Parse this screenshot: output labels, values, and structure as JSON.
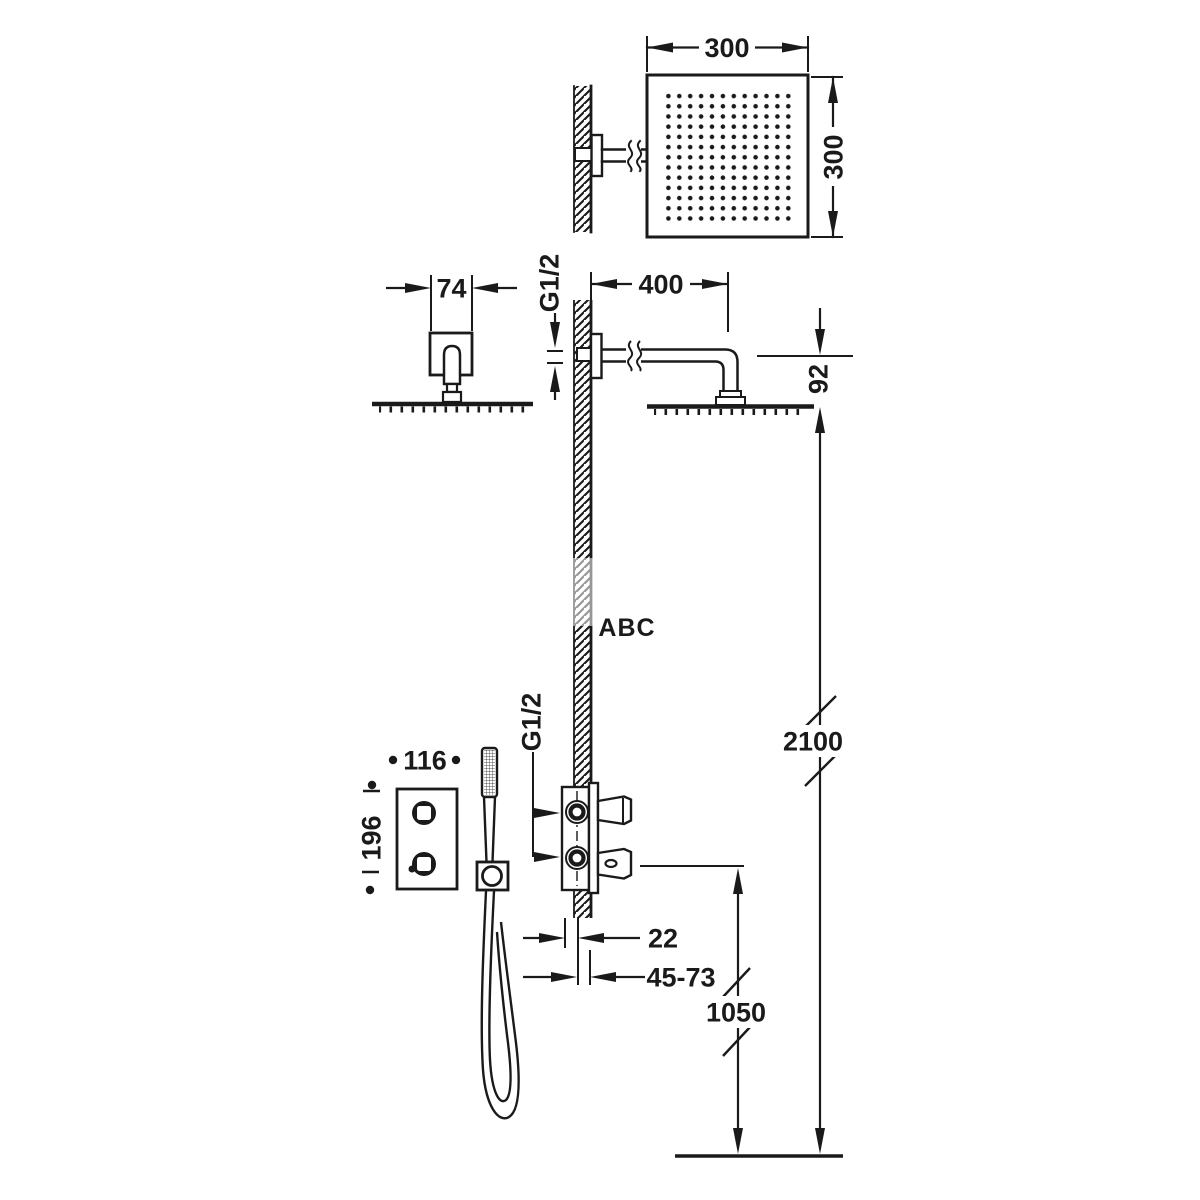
{
  "watermark": {
    "text": "ABC",
    "color": "#8CC63E"
  },
  "dimensions": {
    "head_width": "300",
    "head_depth": "300",
    "escutcheon_width": "74",
    "arm_thread": "G1/2",
    "arm_length": "400",
    "head_offset": "92",
    "valve_width": "116",
    "valve_height": "196",
    "valve_thread": "G1/2",
    "plate_depth": "22",
    "rough_in_depth": "45-73",
    "valve_floor_height": "1050",
    "head_floor_height": "2100"
  }
}
